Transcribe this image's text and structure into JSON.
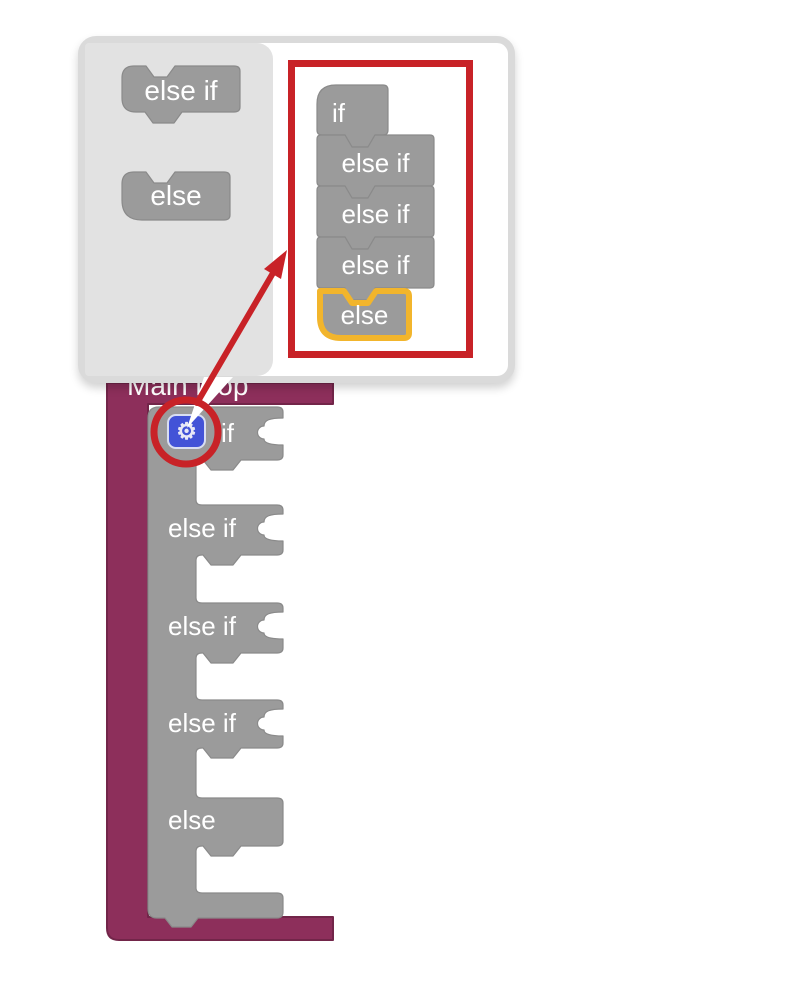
{
  "colors": {
    "block_gray": "#9b9b9b",
    "block_gray_edge": "#8a8a8a",
    "main_loop_magenta": "#8d2f5b",
    "main_loop_edge": "#722549",
    "annotation_red": "#c82227",
    "highlight_yellow": "#f2b52c",
    "gear_blue": "#4353d7",
    "flyout_gray": "#e2e2e2",
    "popup_border_gray": "#dadada"
  },
  "mutator_popup": {
    "palette": [
      {
        "label": "else if"
      },
      {
        "label": "else"
      }
    ],
    "stack": [
      {
        "label": "if"
      },
      {
        "label": "else if"
      },
      {
        "label": "else if"
      },
      {
        "label": "else if"
      },
      {
        "label": "else",
        "highlighted": true
      }
    ]
  },
  "workspace": {
    "main_block_title": "Main loop",
    "if_block": {
      "gear_icon": "gear",
      "gear_glyph": "⚙",
      "rows": [
        {
          "label": "if"
        },
        {
          "label": "else if"
        },
        {
          "label": "else if"
        },
        {
          "label": "else if"
        },
        {
          "label": "else"
        }
      ]
    }
  }
}
